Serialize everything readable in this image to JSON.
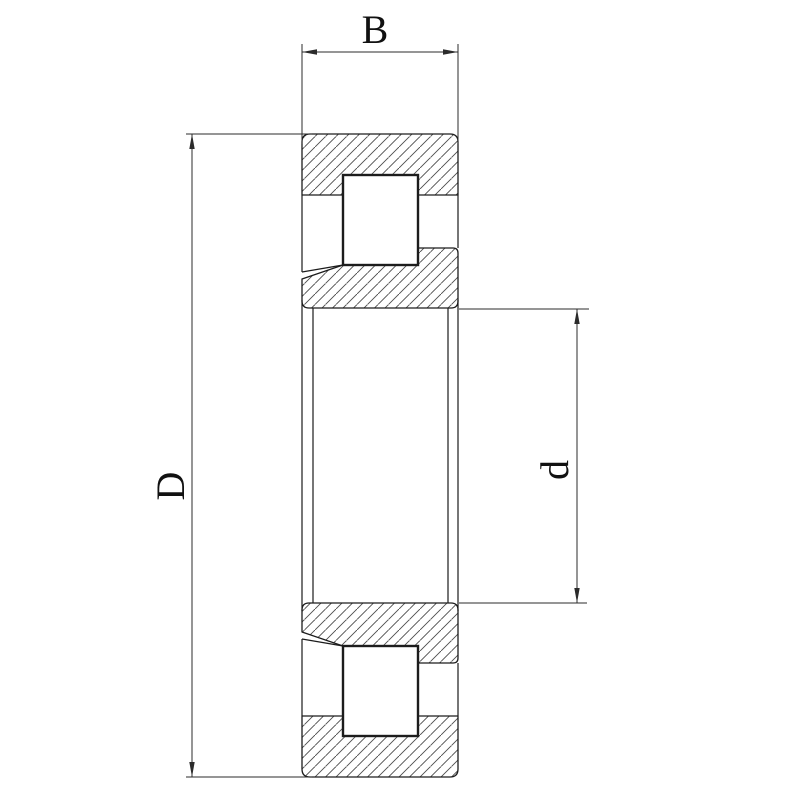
{
  "diagram": {
    "labels": {
      "width_label": "B",
      "outer_diameter_label": "D",
      "bore_diameter_label": "d"
    },
    "colors": {
      "background": "#ffffff",
      "outline": "#1c1c1c",
      "hatch": "#4a4a4a",
      "dimension": "#2b2b2b",
      "text": "#111111"
    }
  }
}
